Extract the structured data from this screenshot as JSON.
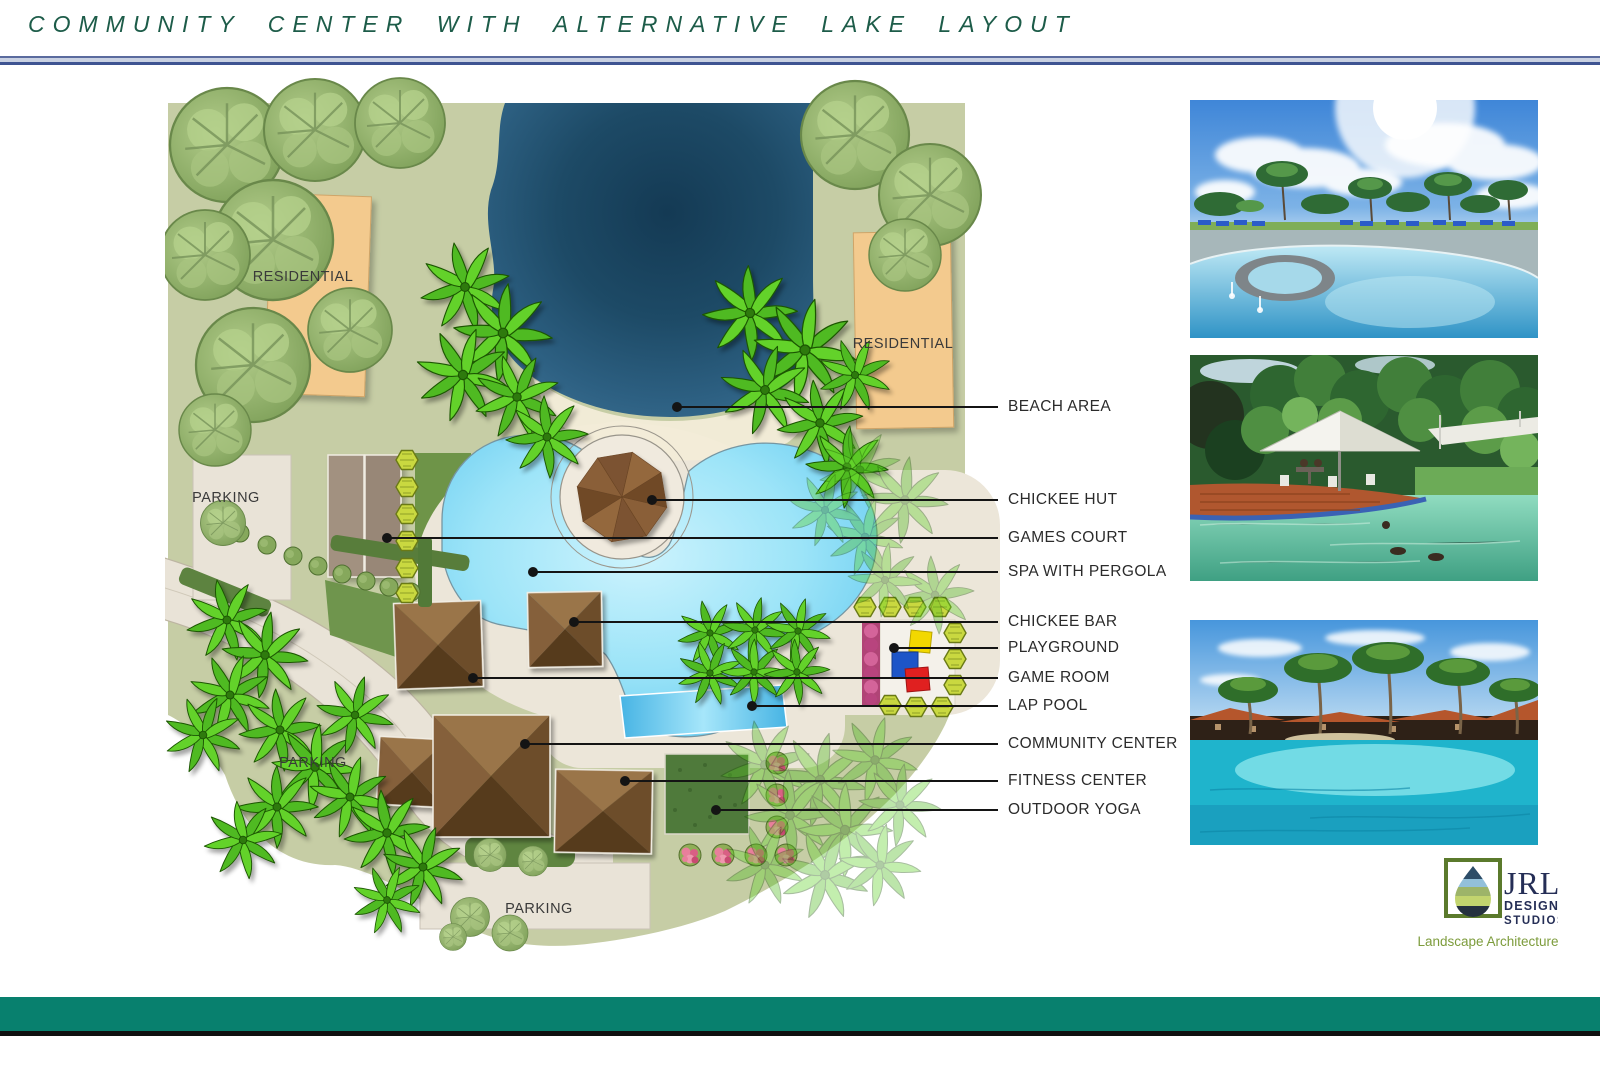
{
  "title": "COMMUNITY CENTER WITH ALTERNATIVE LAKE LAYOUT",
  "plan": {
    "area_labels": {
      "residential_left": "RESIDENTIAL",
      "residential_right": "RESIDENTIAL",
      "parking_top": "PARKING",
      "parking_mid": "PARKING",
      "parking_bottom": "PARKING"
    },
    "legend": {
      "items": [
        "BEACH AREA",
        "CHICKEE HUT",
        "GAMES COURT",
        "SPA WITH PERGOLA",
        "CHICKEE BAR",
        "PLAYGROUND",
        "GAME ROOM",
        "LAP POOL",
        "COMMUNITY CENTER",
        "FITNESS CENTER",
        "OUTDOOR YOGA"
      ]
    }
  },
  "logo": {
    "name": "JRL",
    "line1": "DESIGN",
    "line2": "STUDIOS",
    "tagline": "Landscape Architecture"
  },
  "colors": {
    "title_green": "#1d5c49",
    "divider_blue": "#3f5492",
    "land_green": "#c6cda5",
    "lake_blue": "#1d4a66",
    "pool_blue": "#8fdcf6",
    "deck_cream": "#ece6d9",
    "roof_brown": "#7a5430",
    "residential_tan": "#f3ca8e",
    "parking_beige": "#e9e3d7",
    "footer_teal": "#08806e",
    "logo_navy": "#252e56",
    "logo_green": "#7d9c3c"
  }
}
